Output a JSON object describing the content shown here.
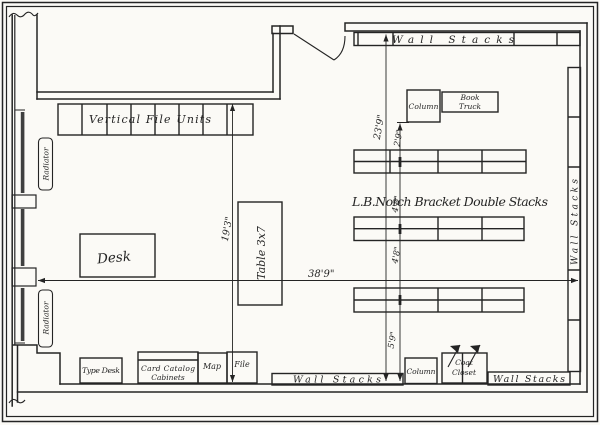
{
  "colors": {
    "ink": "#242424",
    "paper": "#fbfaf6"
  },
  "labels": {
    "vertical_file_units": "Vertical File Units",
    "wall_stacks_top": "Wall Stacks",
    "wall_stacks_right": "Wall Stacks",
    "wall_stacks_bottom_left": "Wall Stacks",
    "wall_stacks_bottom_right": "Wall Stacks",
    "double_stacks_note": "L.B.Notch Bracket Double Stacks",
    "desk": "Desk",
    "table": "Table 3x7",
    "type_desk": "Type Desk",
    "card_catalog_line1": "Card Catalog",
    "card_catalog_line2": "Cabinets",
    "map": "Map",
    "file": "File",
    "column_top": "Column",
    "column_bottom": "Column",
    "book_truck_line1": "Book",
    "book_truck_line2": "Truck",
    "coat_closet_line1": "Coat",
    "coat_closet_line2": "Closet",
    "radiator_top": "Radiator",
    "radiator_bottom": "Radiator"
  },
  "dimensions": {
    "room_width": "38'9\"",
    "left_depth": "19'3\"",
    "right_depth": "23'9\"",
    "column_to_row1": "2'9\"",
    "row1_to_row2": "4'8\"",
    "row2_to_row3": "4'8\"",
    "row3_to_wall": "5'9\""
  }
}
